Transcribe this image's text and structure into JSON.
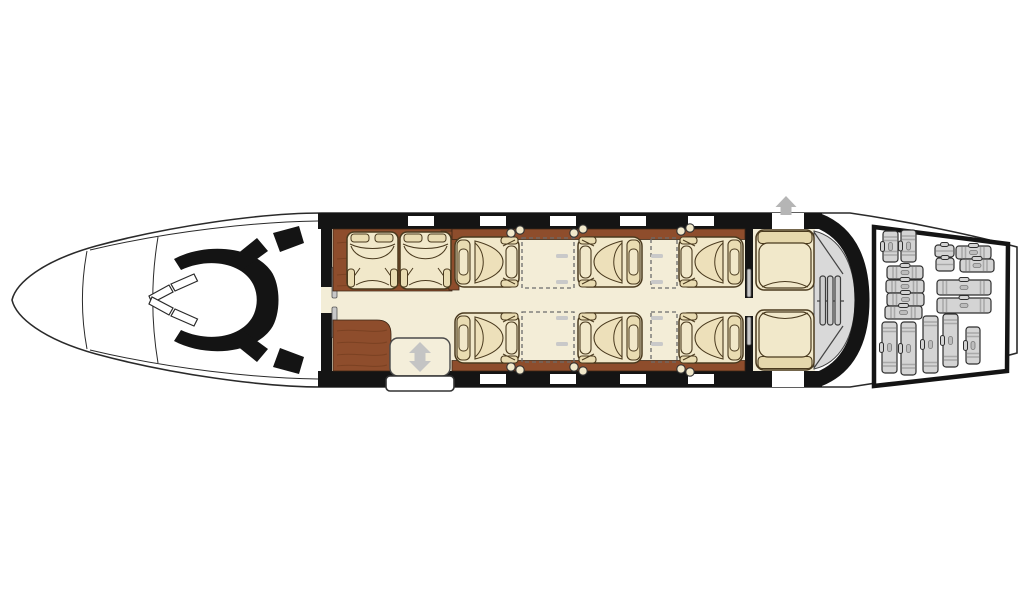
{
  "diagram": {
    "kind": "aircraft-cabin-floorplan",
    "orientation": "nose-left",
    "background": "#ffffff"
  },
  "colors": {
    "outline": "#2a2a2a",
    "black": "#141414",
    "wood": "#8e4d2c",
    "wood_grain": "#6e3a1d",
    "seat": "#f1e8ca",
    "seat_dark": "#e9dcb2",
    "seat_outline": "#4a3a1e",
    "floor": "#f3edd7",
    "lav_gray": "#d9d9d9",
    "louver_gray": "#cfcfcf",
    "arrow_gray": "#b5b5b5",
    "luggage_fill": "#d4d4d4",
    "luggage_band": "#a9a9a9",
    "white": "#ffffff"
  },
  "fuselage": {
    "body_path": "M 12,300 C 16,283 42,261 96,246 C 170,226 262,213 322,213 L 850,213 C 912,222 976,236 1017,247 L 1017,353 C 976,364 912,378 850,387 L 322,387 C 262,387 170,374 96,354 C 42,339 16,317 12,300 Z",
    "nose_lines": [
      "M 87,251 C 81,283 81,317 87,349",
      "M 158,237 C 151,279 151,321 158,363",
      "M 90,250 C 170,231 255,222 318,221",
      "M 90,350 C 170,369 255,378 318,379"
    ],
    "side_bands": [
      {
        "x": 318,
        "y": 213,
        "w": 504,
        "h": 16
      },
      {
        "x": 318,
        "y": 371,
        "w": 504,
        "h": 16
      }
    ],
    "aft_arc_path": "M 818,220.5 C 853,234 862,268 862,300 C 862,332 853,366 818,379.5",
    "windows": {
      "w": 26,
      "h": 10,
      "topY": 216,
      "bottomY": 374,
      "top": [
        408,
        480,
        550,
        620,
        688
      ],
      "bottom": [
        480,
        550,
        620,
        688
      ]
    },
    "exit_gaps": [
      {
        "x": 772,
        "y": 213,
        "w": 32,
        "h": 16
      },
      {
        "x": 772,
        "y": 371,
        "w": 32,
        "h": 16
      }
    ]
  },
  "cockpit": {
    "console_path": "M 174,259 C 204,243 252,245 271,271 C 281,285 281,315 271,329 C 252,355 204,357 174,341 L 181,330 C 209,343 242,337 253,316 C 258,306 258,294 253,284 C 242,263 209,257 181,270 Z",
    "seat_blocks": [
      "231,259 257,238 268,251 242,270",
      "273,233 299,226 304,243 280,252",
      "231,341 257,362 268,349 242,330",
      "273,367 299,374 304,357 280,348"
    ],
    "windshield": [
      "149,296 169,285 173,292 152,303",
      "171,284 194,274 197.5,281 175,291",
      "149,304 169,315 173,308 152,297",
      "171,316 194,326 197.5,319 175,309"
    ]
  },
  "cabin": {
    "floor": {
      "x": 326,
      "y": 229,
      "w": 489,
      "h": 142
    },
    "walls": [
      {
        "name": "forward-bulkhead",
        "bar": {
          "x": 321,
          "y": 213,
          "w": 11,
          "h": 174
        },
        "gap": {
          "x": 321,
          "y": 287,
          "w": 11,
          "h": 26
        },
        "slots": [
          {
            "x": 332,
            "y": 267,
            "w": 5,
            "h": 31
          },
          {
            "x": 332,
            "y": 307,
            "w": 5,
            "h": 31
          }
        ]
      },
      {
        "name": "aft-cabin-divider",
        "bar": {
          "x": 745,
          "y": 213,
          "w": 8,
          "h": 174
        },
        "gap": {
          "x": 745,
          "y": 298,
          "w": 8,
          "h": 18
        },
        "slots": [
          {
            "x": 747,
            "y": 269,
            "w": 4,
            "h": 28
          },
          {
            "x": 747,
            "y": 317,
            "w": 4,
            "h": 28
          }
        ]
      }
    ],
    "wood": [
      {
        "name": "forward-divan-backing",
        "path": "M 333,229 H 452 V 291 H 333 Z",
        "grain": [
          "M 337,243 C 372,239 420,247 447,242",
          "M 337,259 C 380,255 418,263 447,258",
          "M 337,275 C 372,271 420,279 447,274",
          "M 337,286 C 380,283 418,288 447,285"
        ]
      },
      {
        "name": "seat-side-wedge",
        "path": "M 441,231 L 459,231 L 459,290 L 449,290 Z",
        "grain": []
      },
      {
        "name": "sidewall-rail-top",
        "path": "M 452,229 H 745 V 239.5 H 452 Z",
        "grain": []
      },
      {
        "name": "sidewall-rail-bottom",
        "path": "M 452,360.5 H 745 V 371 H 452 Z",
        "grain": []
      },
      {
        "name": "galley-cabinet",
        "path": "M 333,320 H 377 Q 391,320 391,334 V 371 H 333 Z",
        "grain": [
          "M 337,331 C 353,328 374,334 387,330",
          "M 337,343 C 353,340 374,346 387,342",
          "M 337,355 C 353,352 374,358 387,354",
          "M 337,366 C 353,363 374,369 387,365"
        ]
      }
    ],
    "tables": [
      {
        "x": 522,
        "y": 238,
        "w": 52,
        "h": 50
      },
      {
        "x": 651,
        "y": 238,
        "w": 26,
        "h": 50
      },
      {
        "x": 522,
        "y": 312,
        "w": 52,
        "h": 50
      },
      {
        "x": 651,
        "y": 312,
        "w": 26,
        "h": 50
      }
    ],
    "table_ledges": [
      [
        556,
        254
      ],
      [
        556,
        280
      ],
      [
        651,
        254
      ],
      [
        651,
        280
      ],
      [
        556,
        316
      ],
      [
        556,
        342
      ],
      [
        651,
        316
      ],
      [
        651,
        342
      ]
    ],
    "seats": [
      {
        "id": "divan-seat-1",
        "kind": "divan",
        "x": 346,
        "y": 231,
        "flip": ""
      },
      {
        "id": "divan-seat-2",
        "kind": "divan",
        "x": 399,
        "y": 231,
        "flip": ""
      },
      {
        "id": "club-seat-fwd-left",
        "kind": "club",
        "x": 454,
        "y": 236,
        "flip": ""
      },
      {
        "id": "club-seat-mid-left",
        "kind": "club",
        "x": 577,
        "y": 236,
        "flip": "x"
      },
      {
        "id": "club-seat-aft-left",
        "kind": "club",
        "x": 678,
        "y": 236,
        "flip": "x"
      },
      {
        "id": "club-seat-fwd-right",
        "kind": "club",
        "x": 454,
        "y": 312,
        "flip": "y"
      },
      {
        "id": "club-seat-mid-right",
        "kind": "club",
        "x": 577,
        "y": 312,
        "flip": "xy"
      },
      {
        "id": "club-seat-aft-right",
        "kind": "club",
        "x": 678,
        "y": 312,
        "flip": "xy"
      },
      {
        "id": "aft-bench-left",
        "kind": "bench",
        "x": 755,
        "y": 229,
        "flip": ""
      },
      {
        "id": "aft-bench-right",
        "kind": "bench",
        "x": 755,
        "y": 309,
        "flip": "y"
      }
    ],
    "seat_sizes": {
      "club": {
        "w": 66,
        "h": 52
      },
      "divan": {
        "w": 53,
        "h": 59
      },
      "bench": {
        "w": 60,
        "h": 62
      }
    },
    "cupholders": [
      [
        511,
        233
      ],
      [
        520,
        230
      ],
      [
        574,
        233
      ],
      [
        583,
        229
      ],
      [
        681,
        231
      ],
      [
        690,
        228
      ],
      [
        511,
        367
      ],
      [
        520,
        370
      ],
      [
        574,
        367
      ],
      [
        583,
        371
      ],
      [
        681,
        369
      ],
      [
        690,
        372
      ]
    ]
  },
  "doors": {
    "entry": {
      "panel": {
        "x": 390,
        "y": 338,
        "w": 60,
        "h": 38,
        "r": 8
      },
      "sill": {
        "x": 386,
        "y": 376,
        "w": 68,
        "h": 15,
        "r": 4
      },
      "arrow_points": "420,342 431,353 425.5,353 425.5,361 431,361 420,372 409,361 414.5,361 414.5,353 409,353"
    },
    "overwing_exit": {
      "arrow_points": "786,196 796.5,207 791.5,207 791.5,215 780.5,215 780.5,207 775.5,207"
    }
  },
  "lavatory": {
    "body_path": "M 814,231 C 840,237 855,264 855,300 C 855,336 840,363 814,369 Z",
    "divider_lines": [
      "M 814,232 L 843,274",
      "M 814,368 L 843,326",
      "M 817,301 L 844,301"
    ],
    "louvers": [
      820,
      827.5,
      835
    ],
    "louverY": 276,
    "louverW": 5.5,
    "louverH": 49
  },
  "baggage": {
    "outline_points": "874,227 1008,244 1007,371 874,386",
    "items": [
      {
        "x": 883,
        "y": 231,
        "w": 15,
        "h": 31,
        "o": "v"
      },
      {
        "x": 901,
        "y": 230,
        "w": 15,
        "h": 32,
        "o": "v"
      },
      {
        "x": 887,
        "y": 266,
        "w": 36,
        "h": 13,
        "o": "h"
      },
      {
        "x": 886,
        "y": 280,
        "w": 38,
        "h": 13,
        "o": "h"
      },
      {
        "x": 887,
        "y": 293,
        "w": 37,
        "h": 13,
        "o": "h"
      },
      {
        "x": 885,
        "y": 306,
        "w": 37,
        "h": 13,
        "o": "h"
      },
      {
        "x": 935,
        "y": 245,
        "w": 19,
        "h": 12,
        "o": "s"
      },
      {
        "x": 936,
        "y": 258,
        "w": 18,
        "h": 13,
        "o": "s"
      },
      {
        "x": 956,
        "y": 246,
        "w": 35,
        "h": 13,
        "o": "h"
      },
      {
        "x": 960,
        "y": 259,
        "w": 34,
        "h": 13,
        "o": "h"
      },
      {
        "x": 937,
        "y": 280,
        "w": 54,
        "h": 15,
        "o": "h"
      },
      {
        "x": 937,
        "y": 298,
        "w": 54,
        "h": 15,
        "o": "h"
      },
      {
        "x": 882,
        "y": 322,
        "w": 15,
        "h": 51,
        "o": "v"
      },
      {
        "x": 901,
        "y": 322,
        "w": 15,
        "h": 53,
        "o": "v"
      },
      {
        "x": 923,
        "y": 316,
        "w": 15,
        "h": 57,
        "o": "v"
      },
      {
        "x": 943,
        "y": 314,
        "w": 15,
        "h": 53,
        "o": "v"
      },
      {
        "x": 966,
        "y": 327,
        "w": 14,
        "h": 37,
        "o": "v"
      }
    ]
  }
}
